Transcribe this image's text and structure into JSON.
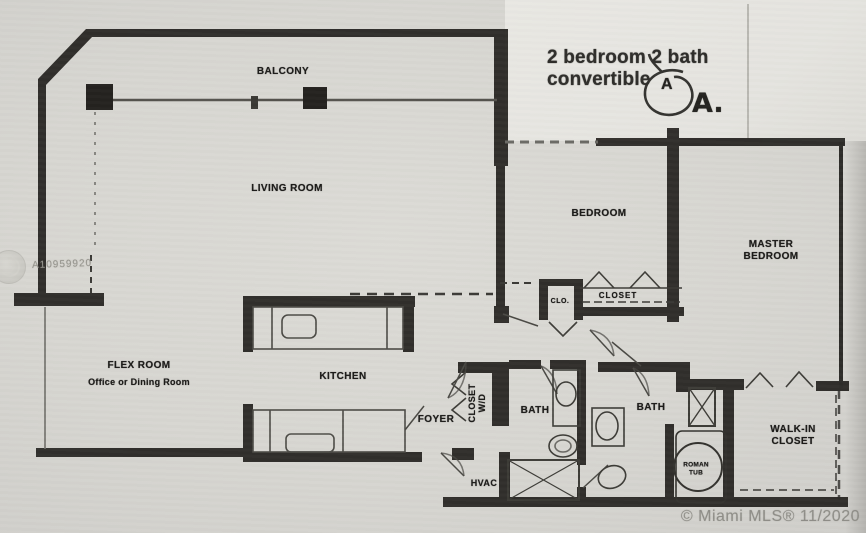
{
  "annotation": {
    "line1": "2 bedroom 2 bath",
    "line2": "convertible",
    "circled_letter": "A",
    "unit_label": "A."
  },
  "watermark": {
    "listing_id": "A10959920"
  },
  "footer": {
    "copyright": "© Miami MLS® 11/2020"
  },
  "rooms": {
    "balcony": "BALCONY",
    "living_room": "LIVING ROOM",
    "bedroom": "BEDROOM",
    "master_line1": "MASTER",
    "master_line2": "BEDROOM",
    "flex_title": "FLEX ROOM",
    "flex_subtitle": "Office or Dining Room",
    "kitchen": "KITCHEN",
    "foyer": "FOYER",
    "closet_wd_line1": "CLOSET",
    "closet_wd_line2": "W/D",
    "bath_hall": "BATH",
    "bath_master": "BATH",
    "walkin_line1": "WALK-IN",
    "walkin_line2": "CLOSET",
    "hvac": "HVAC",
    "roman_tub_line1": "ROMAN",
    "roman_tub_line2": "TUB",
    "bedroom_closet": "CLOSET",
    "hall_closet_abbrev": "CLO."
  }
}
